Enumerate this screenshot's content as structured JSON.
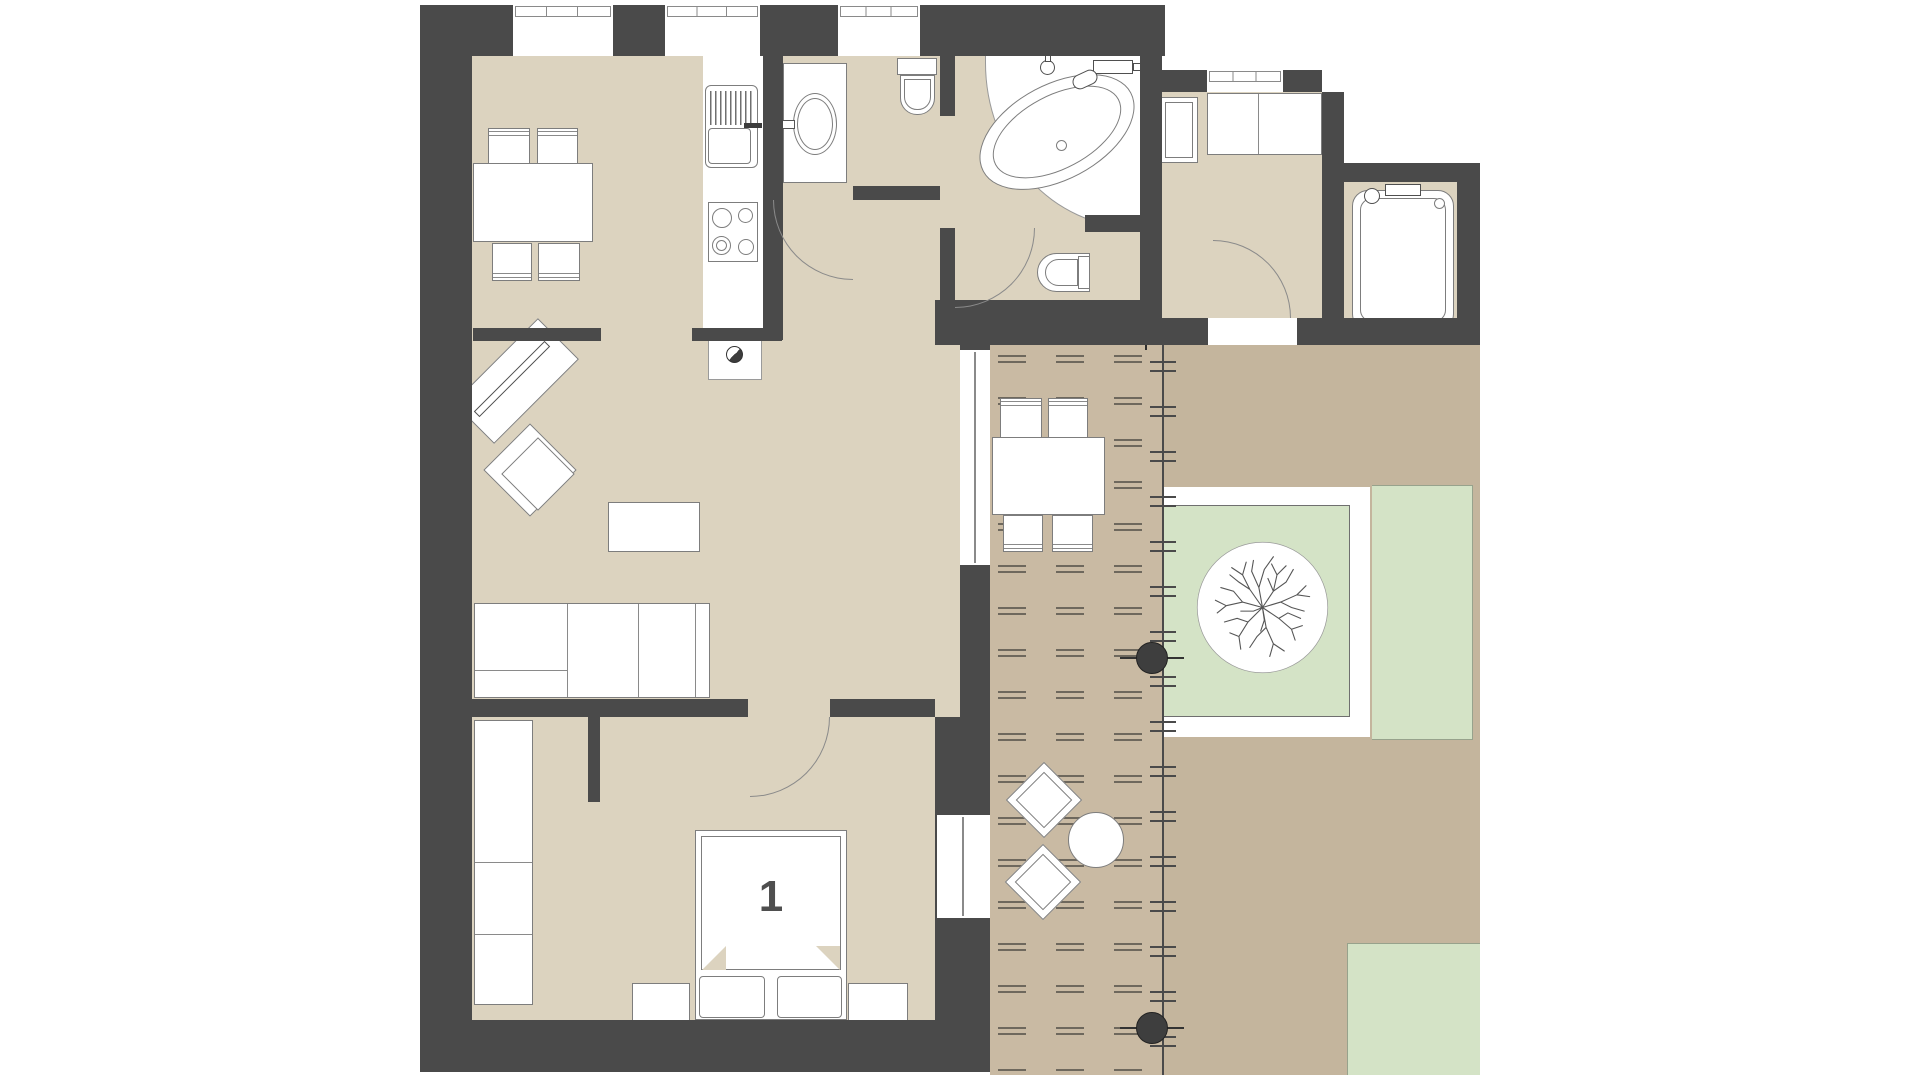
{
  "plan": {
    "type": "apartment-floor-plan",
    "bedroom": {
      "label": "1"
    },
    "rooms": [
      {
        "id": "kitchen-dining"
      },
      {
        "id": "living-room"
      },
      {
        "id": "bedroom",
        "label": "1"
      },
      {
        "id": "wc-washroom"
      },
      {
        "id": "bathroom-with-corner-tub"
      },
      {
        "id": "entry-hall"
      },
      {
        "id": "side-bathroom"
      },
      {
        "id": "terrace-deck"
      },
      {
        "id": "garden"
      }
    ],
    "furniture": [
      "dining-table",
      "dining-chairs",
      "kitchen-sink",
      "kitchen-stove",
      "tv-console",
      "armchair",
      "corner-sofa",
      "coffee-table",
      "washbasin",
      "toilet",
      "corner-bathtub",
      "second-toilet",
      "entry-cabinets",
      "side-bathtub",
      "double-bed",
      "nightstands",
      "wardrobe",
      "outdoor-table",
      "outdoor-chairs",
      "lounge-chairs",
      "round-side-table",
      "tree-planter",
      "pergola-columns"
    ],
    "colors": {
      "wall": "#4a4a4a",
      "floor": "#dcd3bf",
      "deck": "#c9baa3",
      "garden": "#c4b59d",
      "grass": "#d4e3c6",
      "outline": "#8a8a8a",
      "furniture_fill": "#ffffff"
    }
  }
}
